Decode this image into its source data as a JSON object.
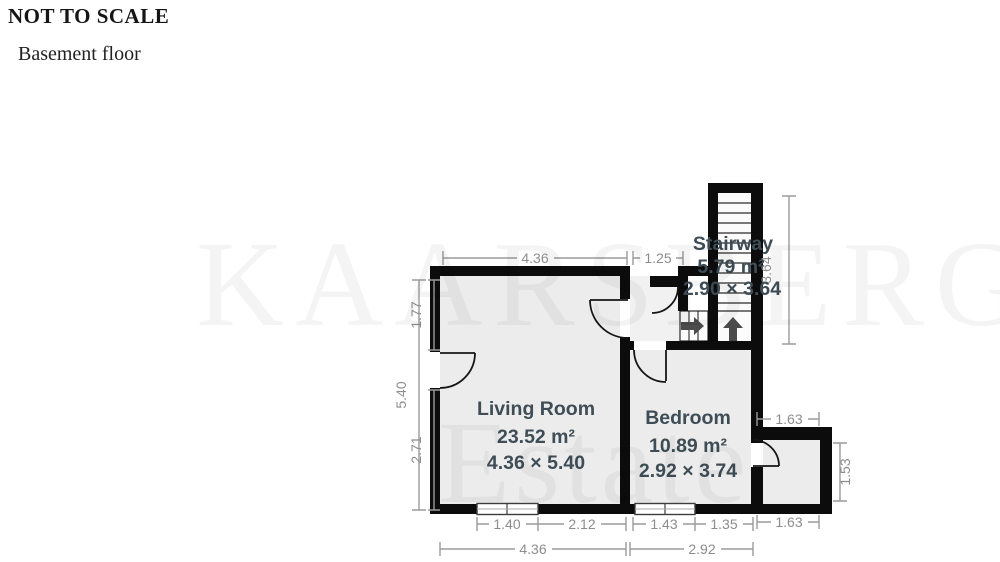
{
  "header": {
    "scale_note": "NOT TO SCALE",
    "floor_label": "Basement floor"
  },
  "watermark": {
    "line1": "KAARSBERG",
    "line2": "Estate"
  },
  "rooms": [
    {
      "name": "Living Room",
      "area": "23.52 m²",
      "dimensions": "4.36 × 5.40"
    },
    {
      "name": "Bedroom",
      "area": "10.89 m²",
      "dimensions": "2.92 × 3.74"
    },
    {
      "name": "Stairway",
      "area": "5.79 m²",
      "dimensions": "2.90 × 3.64"
    }
  ],
  "dimension_labels": {
    "top_living_width": "4.36",
    "top_hall_width": "1.25",
    "left_upper": "1.77",
    "left_total": "5.40",
    "left_lower": "2.71",
    "bottom_window_living": "1.40",
    "bottom_living_right": "2.12",
    "bottom_window_bedroom": "1.43",
    "bottom_bedroom_right": "1.35",
    "bottom_living_total": "4.36",
    "bottom_bedroom_total": "2.92",
    "alcove_top": "1.63",
    "alcove_right": "1.53",
    "alcove_bottom": "1.63",
    "stair_height": "3.64"
  },
  "colors": {
    "wall": "#0c0c0c",
    "room_fill": "#ececec",
    "hall_fill": "#f1f1f1",
    "shaft_fill": "#fbfbfb",
    "label_text": "#3e4d56",
    "dimension_text": "#8d8d8d",
    "dimension_line": "#9b9b9b",
    "arrow": "#4b4b4b"
  }
}
